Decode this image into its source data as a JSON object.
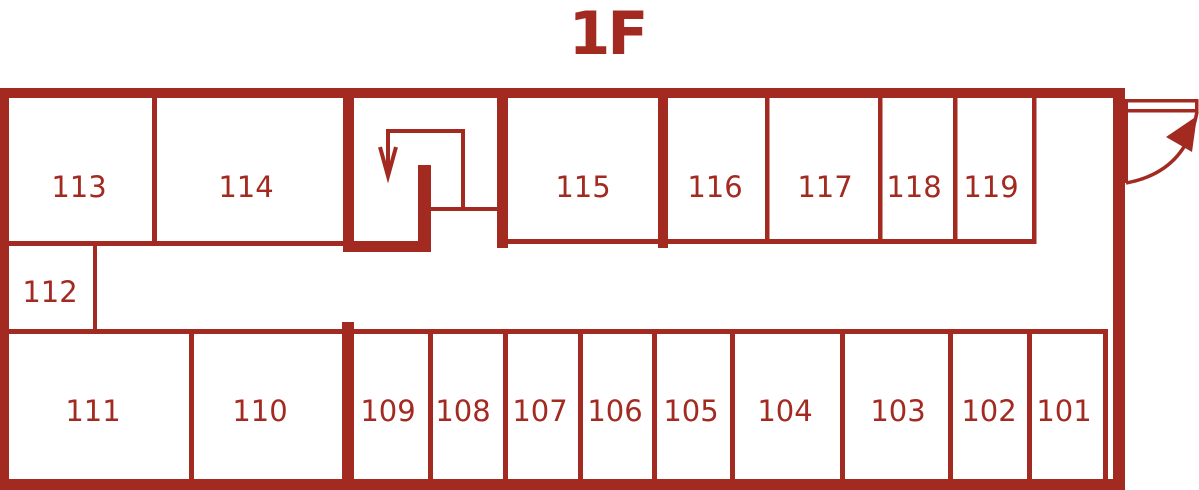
{
  "title": "1F",
  "colors": {
    "accent": "#A32A21",
    "background": "#FFFFFF"
  },
  "floor_plan": {
    "top_rooms": [
      {
        "label": "113"
      },
      {
        "label": "114"
      },
      {
        "label": "115"
      },
      {
        "label": "116"
      },
      {
        "label": "117"
      },
      {
        "label": "118"
      },
      {
        "label": "119"
      }
    ],
    "middle_rooms": [
      {
        "label": "112"
      }
    ],
    "bottom_rooms": [
      {
        "label": "111"
      },
      {
        "label": "110"
      },
      {
        "label": "109"
      },
      {
        "label": "108"
      },
      {
        "label": "107"
      },
      {
        "label": "106"
      },
      {
        "label": "105"
      },
      {
        "label": "104"
      },
      {
        "label": "103"
      },
      {
        "label": "102"
      },
      {
        "label": "101"
      }
    ],
    "symbols": [
      {
        "name": "stairs-down-arrow"
      },
      {
        "name": "entrance-door-swing"
      }
    ]
  }
}
